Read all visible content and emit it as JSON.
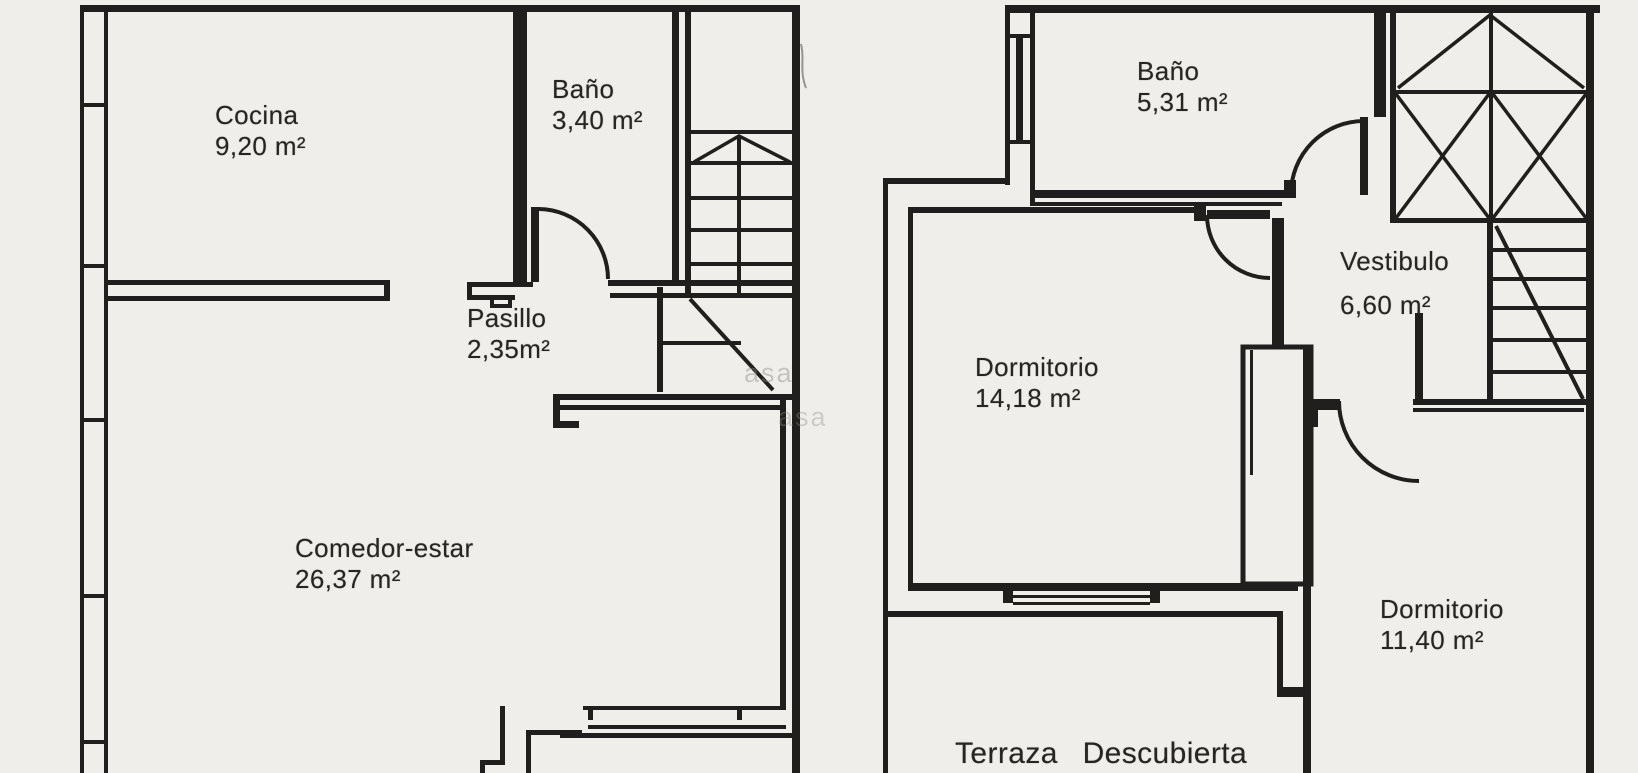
{
  "document": {
    "kind": "scanned floor plan",
    "background_color": "#f0eeea",
    "line_color": "#201f1d"
  },
  "watermark": {
    "fragment_1": "asa",
    "fragment_2": "asa"
  },
  "plans": {
    "ground": {
      "label": "ground-floor",
      "rooms": [
        {
          "name": "Cocina",
          "area": "9,20 m²"
        },
        {
          "name": "Baño",
          "area": "3,40 m²"
        },
        {
          "name": "Pasillo",
          "area": "2,35m²"
        },
        {
          "name": "Comedor-estar",
          "area": "26,37 m²"
        }
      ]
    },
    "upper": {
      "label": "upper-floor",
      "rooms": [
        {
          "name": "Baño",
          "area": "5,31 m²"
        },
        {
          "name": "Vestibulo",
          "area": "6,60 m²"
        },
        {
          "name": "Dormitorio",
          "area": "14,18 m²"
        },
        {
          "name": "Dormitorio",
          "area": "11,40 m²"
        },
        {
          "name": "Terraza Descubierta",
          "area": ""
        }
      ]
    }
  }
}
